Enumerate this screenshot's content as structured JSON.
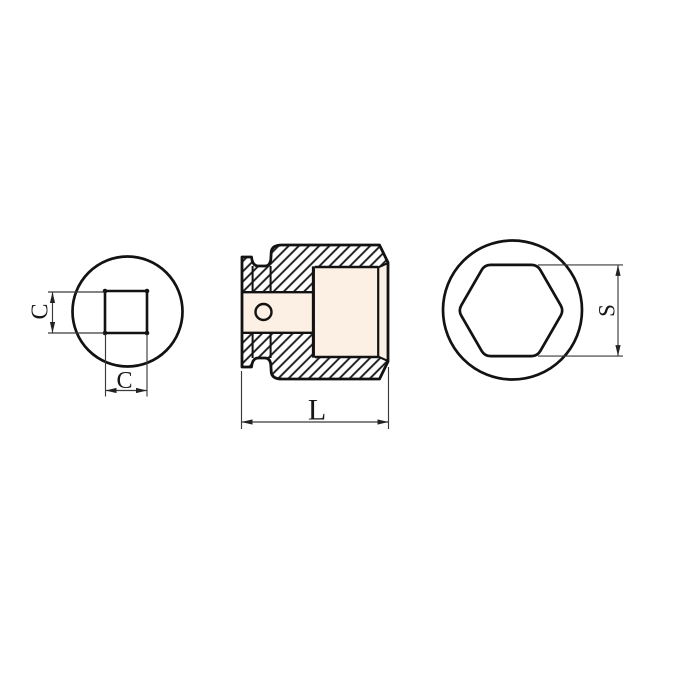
{
  "colors": {
    "background": "#ffffff",
    "part_fill": "#f9e6d3",
    "hole_fill": "#fcf0e4",
    "outline": "#121212",
    "hatch_line": "#1a1a1a",
    "dimension_line": "#3a3a3a",
    "label_color": "#161616"
  },
  "views": {
    "square_drive_end": {
      "dim_side": "C",
      "dim_bottom": "C"
    },
    "section": {
      "dim_length": "L"
    },
    "hex_socket_end": {
      "dim_across_flats": "S"
    }
  }
}
